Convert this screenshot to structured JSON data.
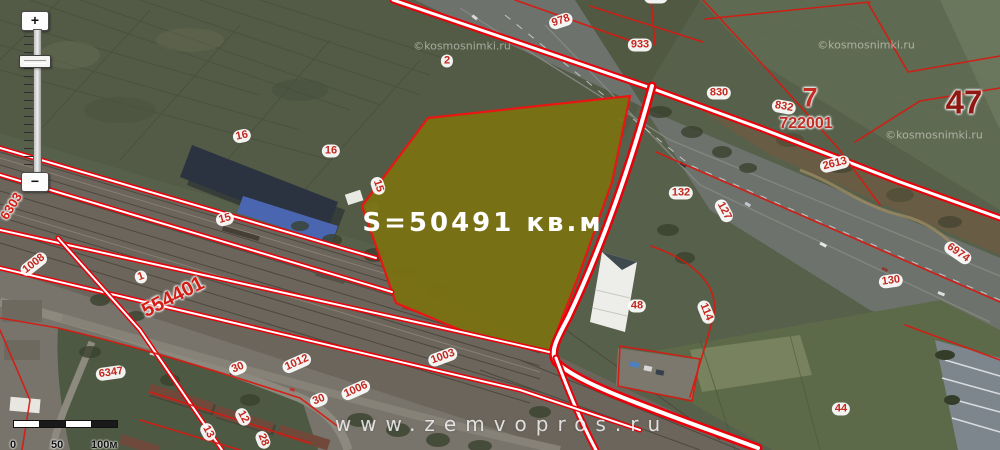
{
  "map": {
    "parcel": {
      "area_label": "S=50491 кв.м",
      "fill": "#7a7113",
      "outline": "#ef1411"
    },
    "watermarks": {
      "site": "www.zemvopros.ru",
      "imagery": "©kosmosnimki.ru",
      "imagery_positions": [
        {
          "x": 462,
          "y": 46
        },
        {
          "x": 866,
          "y": 45
        },
        {
          "x": 934,
          "y": 135
        }
      ]
    },
    "colors": {
      "cadastral_red": "#e8000a",
      "label_red": "#c3271e"
    },
    "labels": [
      {
        "t": "978",
        "x": 561,
        "y": 21,
        "r": -18,
        "k": "b"
      },
      {
        "t": "933",
        "x": 640,
        "y": 45,
        "r": 0,
        "k": "b"
      },
      {
        "t": "888",
        "x": 656,
        "y": -3,
        "r": 0,
        "k": "b"
      },
      {
        "t": "2",
        "x": 447,
        "y": 61,
        "r": 0,
        "k": "b"
      },
      {
        "t": "16",
        "x": 242,
        "y": 136,
        "r": -12,
        "k": "b"
      },
      {
        "t": "16",
        "x": 331,
        "y": 151,
        "r": 0,
        "k": "b"
      },
      {
        "t": "15",
        "x": 225,
        "y": 219,
        "r": -15,
        "k": "b"
      },
      {
        "t": "15",
        "x": 378,
        "y": 186,
        "r": 72,
        "k": "b"
      },
      {
        "t": "830",
        "x": 719,
        "y": 93,
        "r": 0,
        "k": "b"
      },
      {
        "t": "832",
        "x": 784,
        "y": 107,
        "r": 10,
        "k": "b"
      },
      {
        "t": "2613",
        "x": 835,
        "y": 164,
        "r": -14,
        "k": "b"
      },
      {
        "t": "132",
        "x": 681,
        "y": 193,
        "r": 0,
        "k": "b"
      },
      {
        "t": "127",
        "x": 724,
        "y": 211,
        "r": 62,
        "k": "b"
      },
      {
        "t": "6974",
        "x": 958,
        "y": 253,
        "r": 35,
        "k": "b"
      },
      {
        "t": "130",
        "x": 891,
        "y": 281,
        "r": -8,
        "k": "b"
      },
      {
        "t": "48",
        "x": 637,
        "y": 306,
        "r": 0,
        "k": "b"
      },
      {
        "t": "114",
        "x": 706,
        "y": 312,
        "r": 68,
        "k": "b"
      },
      {
        "t": "44",
        "x": 841,
        "y": 409,
        "r": 0,
        "k": "b"
      },
      {
        "t": "6347",
        "x": 111,
        "y": 373,
        "r": -8,
        "k": "b"
      },
      {
        "t": "1008",
        "x": 34,
        "y": 264,
        "r": -38,
        "k": "b"
      },
      {
        "t": "1",
        "x": 141,
        "y": 277,
        "r": -20,
        "k": "b"
      },
      {
        "t": "1012",
        "x": 297,
        "y": 363,
        "r": -24,
        "k": "b"
      },
      {
        "t": "30",
        "x": 238,
        "y": 368,
        "r": -22,
        "k": "b"
      },
      {
        "t": "30",
        "x": 319,
        "y": 400,
        "r": -22,
        "k": "b"
      },
      {
        "t": "1006",
        "x": 356,
        "y": 390,
        "r": -24,
        "k": "b"
      },
      {
        "t": "1003",
        "x": 443,
        "y": 357,
        "r": -20,
        "k": "b"
      },
      {
        "t": "12",
        "x": 243,
        "y": 417,
        "r": 62,
        "k": "b"
      },
      {
        "t": "13",
        "x": 208,
        "y": 432,
        "r": 62,
        "k": "b"
      },
      {
        "t": "28",
        "x": 263,
        "y": 440,
        "r": 68,
        "k": "b"
      },
      {
        "t": "7",
        "x": 810,
        "y": 98,
        "r": 0,
        "k": "p",
        "size": 27,
        "color": "#c42b22"
      },
      {
        "t": "722001",
        "x": 806,
        "y": 124,
        "r": 0,
        "k": "p",
        "size": 16,
        "color": "#c42b22"
      },
      {
        "t": "47",
        "x": 964,
        "y": 102,
        "r": 0,
        "k": "p",
        "size": 33,
        "color": "#8f1812"
      },
      {
        "t": "554401",
        "x": 173,
        "y": 297,
        "r": -27,
        "k": "p",
        "size": 20,
        "color": "#d31c13"
      },
      {
        "t": "6303",
        "x": 11,
        "y": 206,
        "r": -58,
        "k": "p",
        "size": 13,
        "color": "#d31c13"
      }
    ]
  },
  "controls": {
    "zoom_in_label": "+",
    "zoom_out_label": "−"
  },
  "scale_bar": {
    "labels": [
      "0",
      "50",
      "100м"
    ]
  }
}
